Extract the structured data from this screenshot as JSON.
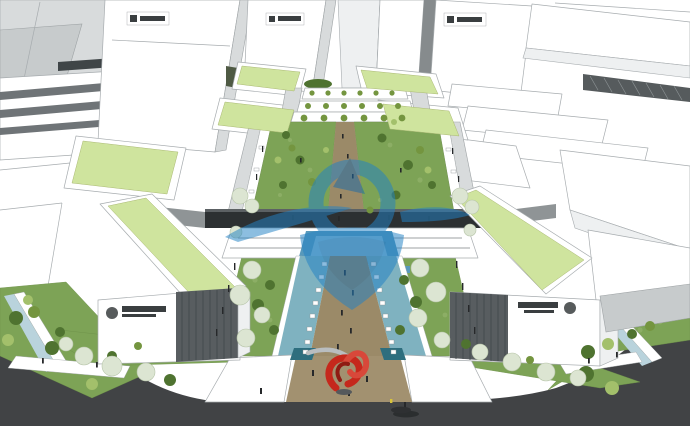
{
  "meta": {
    "title": "Aerial 3D architectural massing rendering: white office blocks with green roofs around a central landscaped pedestrian axis",
    "style": "SketchUp-style render",
    "view": "bird's-eye perspective, vanishing point near top center"
  },
  "palette": {
    "roof_green": "#cfe49e",
    "lawn_green": "#7da356",
    "lawn_light": "#9ab873",
    "bush_dark": "#4f7330",
    "bush_mid": "#74953f",
    "bush_light": "#a3c06b",
    "blossom": "#dce5d2",
    "path_tan": "#9b8a68",
    "plaza_tan": "#a29170",
    "water_teal": "#7fb2c0",
    "pool_blue": "#5899bb",
    "pool_blue_light": "#8cbcd6",
    "channel_blue": "#b9d3dc",
    "water_dark": "#2e6e7e",
    "bridge_dark": "#2c3032",
    "road_gray": "#414345",
    "louver_dark": "#585d60",
    "sign_dark": "#3a3e40",
    "watermark_blue": "#2382c4",
    "watermark_blue_dark": "#1b6aa8",
    "sculpture_red": "#c5281c",
    "sculpture_red_dark": "#8f1b13",
    "sculpture_red_light": "#d8483a",
    "people_dark": "#26282a",
    "car_yellow": "#d8c43a"
  },
  "watermark": {
    "present": true,
    "description": "large translucent blue abstract logo watermark over image center",
    "opacity": 0.52
  },
  "signs": [
    {
      "id": "tower-sign-left",
      "location": "top-left tower facade",
      "text": "",
      "legible": false
    },
    {
      "id": "tower-sign-center",
      "location": "upper-center tower facade",
      "text": "",
      "legible": false
    },
    {
      "id": "tower-sign-right",
      "location": "upper-right tower facade",
      "text": "",
      "legible": false
    },
    {
      "id": "building-sign-left",
      "location": "left foreground building facade",
      "text": "",
      "legible": false
    },
    {
      "id": "building-sign-right",
      "location": "right foreground building facade",
      "text": "",
      "legible": false
    }
  ],
  "scene": {
    "buildings": "white prismatic towers and slab blocks; several podium blocks carry flat light-green roofs; two foreground slabs have long green roofs, dark louvered corner sections and company sign plaques",
    "center_axis": "landscaped spine with lawns, round shrubs, blossom trees, tan walkway, teal water bands lined with white benches, lamp posts",
    "bridge": "dark elevated walkway crossing the axis mid-image",
    "pool": "blue stepped reflecting pool below the bridge",
    "terraced_building": "central stepped building with planted balconies",
    "plaza": "tan foreground plaza with red ribbon sculpture and pedestrians",
    "roads": "dark asphalt perimeter roads with white sidewalks, lawn wedges, a car and tiny pedestrians"
  }
}
